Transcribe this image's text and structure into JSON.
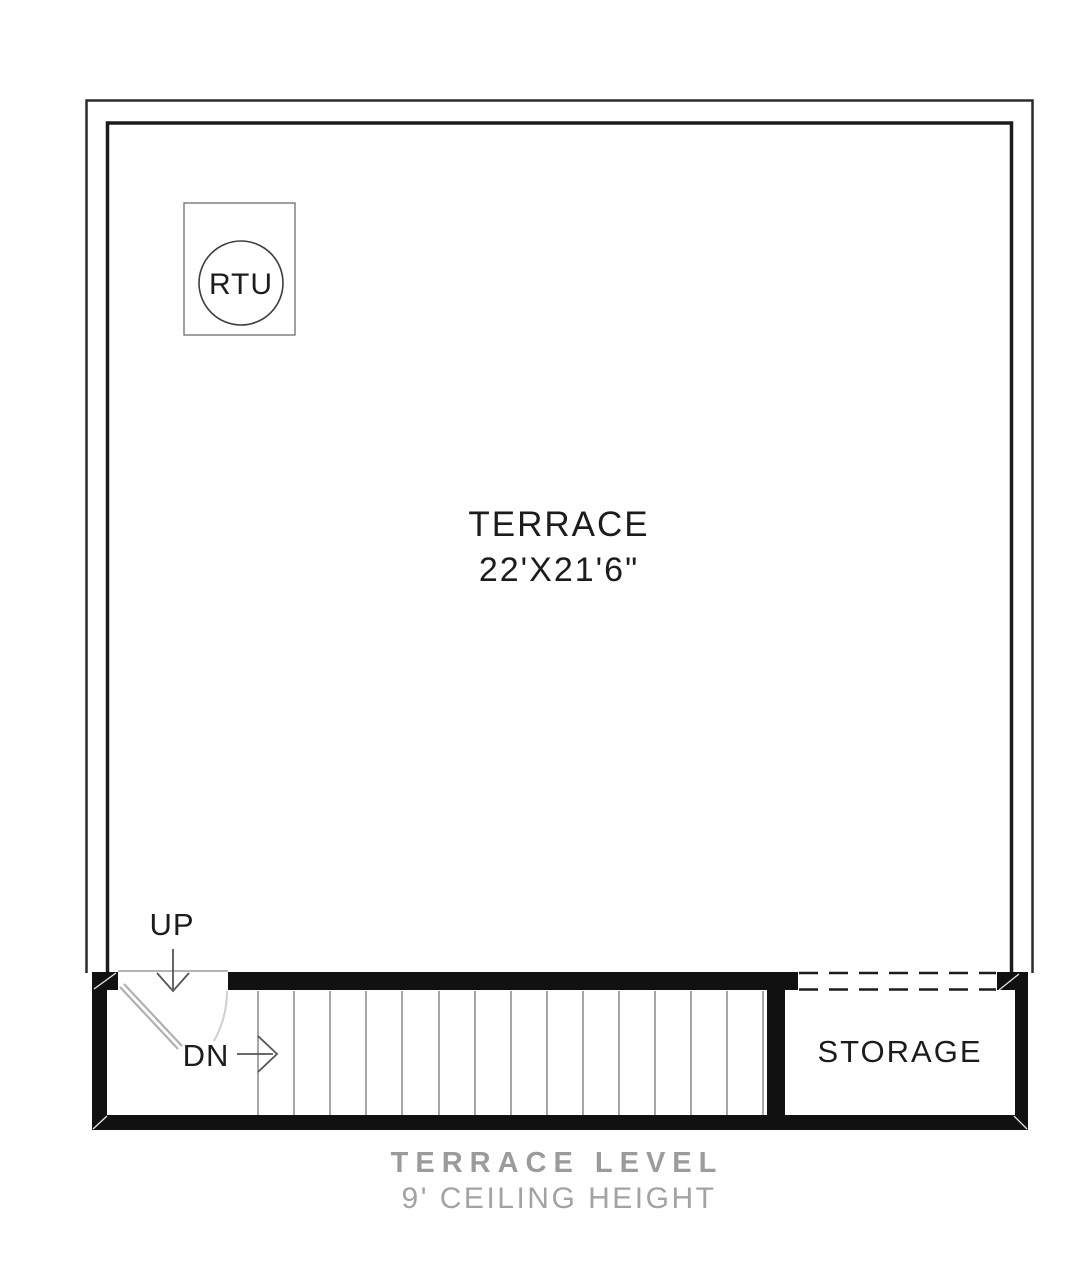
{
  "plan": {
    "terrace": {
      "name": "TERRACE",
      "dimensions": "22'X21'6\""
    },
    "rtu": {
      "label": "RTU"
    },
    "storage": {
      "name": "STORAGE"
    },
    "stairs": {
      "up_label": "UP",
      "down_label": "DN",
      "tread_count": 15
    }
  },
  "caption": {
    "title": "TERRACE LEVEL",
    "subtitle": "9' CEILING HEIGHT"
  },
  "colors": {
    "background": "#ffffff",
    "wall": "#111111",
    "thin_line": "#2b2b2b",
    "tread": "#8f8f8f",
    "door": "#b0b0b0",
    "caption_gray": "#9b9b9b"
  }
}
